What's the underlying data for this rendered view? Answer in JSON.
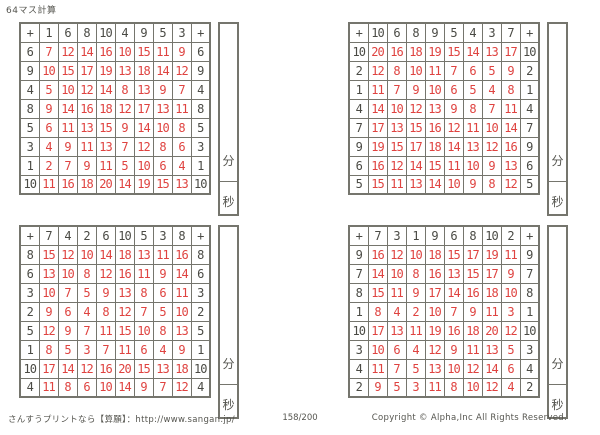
{
  "title": "64マス計算",
  "labels": {
    "minutes": "分",
    "seconds": "秒"
  },
  "colors": {
    "answer_red": "#df4340",
    "operand_gray": "#4a4a44",
    "border_gray": "#75756d"
  },
  "grids": [
    {
      "name": "top-left",
      "header": [
        "+",
        "1",
        "6",
        "8",
        "10",
        "4",
        "9",
        "5",
        "3",
        "+"
      ],
      "rows": [
        [
          "6",
          "7",
          "12",
          "14",
          "16",
          "10",
          "15",
          "11",
          "9",
          "6"
        ],
        [
          "9",
          "10",
          "15",
          "17",
          "19",
          "13",
          "18",
          "14",
          "12",
          "9"
        ],
        [
          "4",
          "5",
          "10",
          "12",
          "14",
          "8",
          "13",
          "9",
          "7",
          "4"
        ],
        [
          "8",
          "9",
          "14",
          "16",
          "18",
          "12",
          "17",
          "13",
          "11",
          "8"
        ],
        [
          "5",
          "6",
          "11",
          "13",
          "15",
          "9",
          "14",
          "10",
          "8",
          "5"
        ],
        [
          "3",
          "4",
          "9",
          "11",
          "13",
          "7",
          "12",
          "8",
          "6",
          "3"
        ],
        [
          "1",
          "2",
          "7",
          "9",
          "11",
          "5",
          "10",
          "6",
          "4",
          "1"
        ],
        [
          "10",
          "11",
          "16",
          "18",
          "20",
          "14",
          "19",
          "15",
          "13",
          "10"
        ]
      ]
    },
    {
      "name": "top-right",
      "header": [
        "+",
        "10",
        "6",
        "8",
        "9",
        "5",
        "4",
        "3",
        "7",
        "+"
      ],
      "rows": [
        [
          "10",
          "20",
          "16",
          "18",
          "19",
          "15",
          "14",
          "13",
          "17",
          "10"
        ],
        [
          "2",
          "12",
          "8",
          "10",
          "11",
          "7",
          "6",
          "5",
          "9",
          "2"
        ],
        [
          "1",
          "11",
          "7",
          "9",
          "10",
          "6",
          "5",
          "4",
          "8",
          "1"
        ],
        [
          "4",
          "14",
          "10",
          "12",
          "13",
          "9",
          "8",
          "7",
          "11",
          "4"
        ],
        [
          "7",
          "17",
          "13",
          "15",
          "16",
          "12",
          "11",
          "10",
          "14",
          "7"
        ],
        [
          "9",
          "19",
          "15",
          "17",
          "18",
          "14",
          "13",
          "12",
          "16",
          "9"
        ],
        [
          "6",
          "16",
          "12",
          "14",
          "15",
          "11",
          "10",
          "9",
          "13",
          "6"
        ],
        [
          "5",
          "15",
          "11",
          "13",
          "14",
          "10",
          "9",
          "8",
          "12",
          "5"
        ]
      ]
    },
    {
      "name": "bottom-left",
      "header": [
        "+",
        "7",
        "4",
        "2",
        "6",
        "10",
        "5",
        "3",
        "8",
        "+"
      ],
      "rows": [
        [
          "8",
          "15",
          "12",
          "10",
          "14",
          "18",
          "13",
          "11",
          "16",
          "8"
        ],
        [
          "6",
          "13",
          "10",
          "8",
          "12",
          "16",
          "11",
          "9",
          "14",
          "6"
        ],
        [
          "3",
          "10",
          "7",
          "5",
          "9",
          "13",
          "8",
          "6",
          "11",
          "3"
        ],
        [
          "2",
          "9",
          "6",
          "4",
          "8",
          "12",
          "7",
          "5",
          "10",
          "2"
        ],
        [
          "5",
          "12",
          "9",
          "7",
          "11",
          "15",
          "10",
          "8",
          "13",
          "5"
        ],
        [
          "1",
          "8",
          "5",
          "3",
          "7",
          "11",
          "6",
          "4",
          "9",
          "1"
        ],
        [
          "10",
          "17",
          "14",
          "12",
          "16",
          "20",
          "15",
          "13",
          "18",
          "10"
        ],
        [
          "4",
          "11",
          "8",
          "6",
          "10",
          "14",
          "9",
          "7",
          "12",
          "4"
        ]
      ]
    },
    {
      "name": "bottom-right",
      "header": [
        "+",
        "7",
        "3",
        "1",
        "9",
        "6",
        "8",
        "10",
        "2",
        "+"
      ],
      "rows": [
        [
          "9",
          "16",
          "12",
          "10",
          "18",
          "15",
          "17",
          "19",
          "11",
          "9"
        ],
        [
          "7",
          "14",
          "10",
          "8",
          "16",
          "13",
          "15",
          "17",
          "9",
          "7"
        ],
        [
          "8",
          "15",
          "11",
          "9",
          "17",
          "14",
          "16",
          "18",
          "10",
          "8"
        ],
        [
          "1",
          "8",
          "4",
          "2",
          "10",
          "7",
          "9",
          "11",
          "3",
          "1"
        ],
        [
          "10",
          "17",
          "13",
          "11",
          "19",
          "16",
          "18",
          "20",
          "12",
          "10"
        ],
        [
          "3",
          "10",
          "6",
          "4",
          "12",
          "9",
          "11",
          "13",
          "5",
          "3"
        ],
        [
          "4",
          "11",
          "7",
          "5",
          "13",
          "10",
          "12",
          "14",
          "6",
          "4"
        ],
        [
          "2",
          "9",
          "5",
          "3",
          "11",
          "8",
          "10",
          "12",
          "4",
          "2"
        ]
      ]
    }
  ],
  "footer": {
    "site": "さんすうプリントなら【算願】：http://www.sangan.jp/",
    "page": "158/200",
    "copyright": "Copyright © Alpha,Inc All Rights Reserved."
  }
}
